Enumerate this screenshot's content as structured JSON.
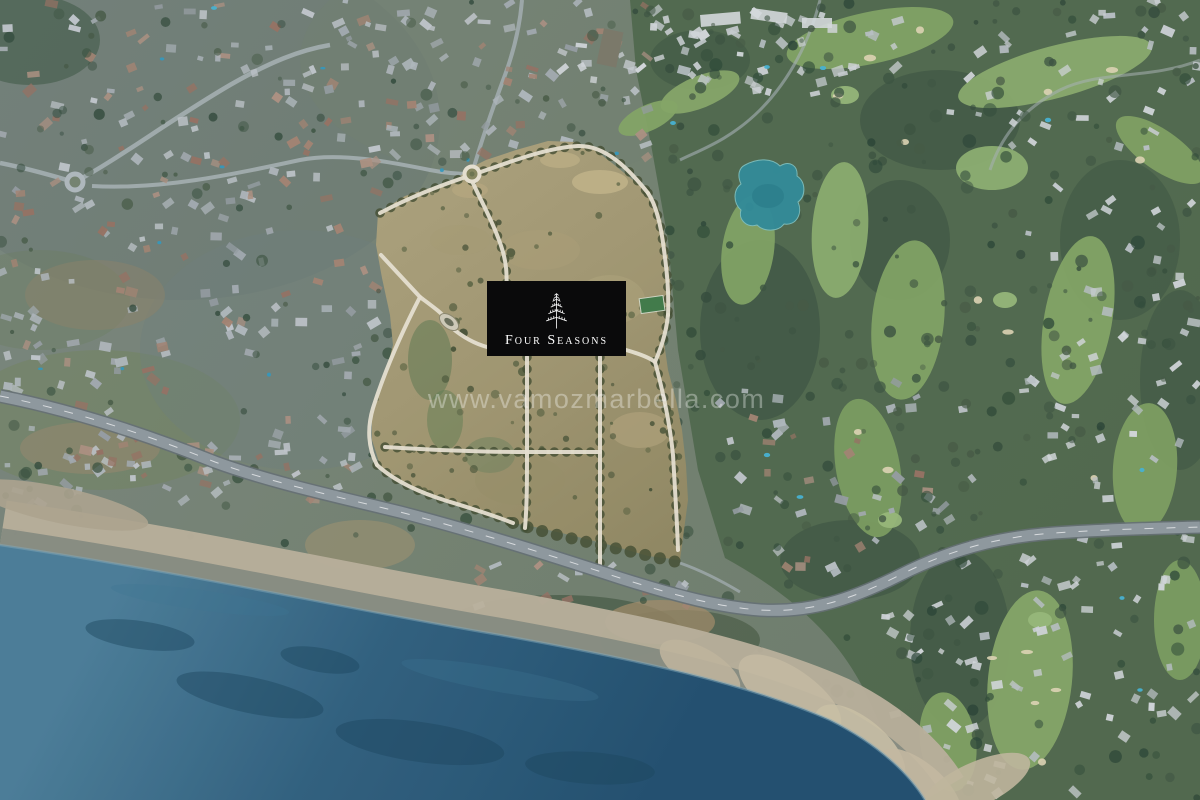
{
  "scene": {
    "type": "aerial-photograph",
    "description": "Satellite aerial view of a large tan development plot outlined by white tree-lined roads, surrounded by residential villas, a golf course with a lake on the right, a coastal highway, a beach and the sea in the lower left.",
    "palette": {
      "land_base": "#75836f",
      "plot_tan": "#a89c72",
      "golf_green": "#84a862",
      "golf_dark": "#4e6747",
      "road_white": "#f1ead7",
      "tree_dark": "#3a523c",
      "highway_gray": "#939da1",
      "sand": "#c2b69e",
      "wet_sand": "#868c7f",
      "sea_shallow": "#4a7f9a",
      "sea_deep": "#1e4e6e",
      "lake_teal": "#2f8e9a",
      "logo_bg": "#0a0a0b",
      "logo_text": "#ffffff"
    }
  },
  "overlay": {
    "logo": {
      "brand_label": "Four Seasons",
      "icon": "four-seasons-tree-logo"
    },
    "watermark": {
      "text": "www.vamozmarbella.com"
    }
  }
}
